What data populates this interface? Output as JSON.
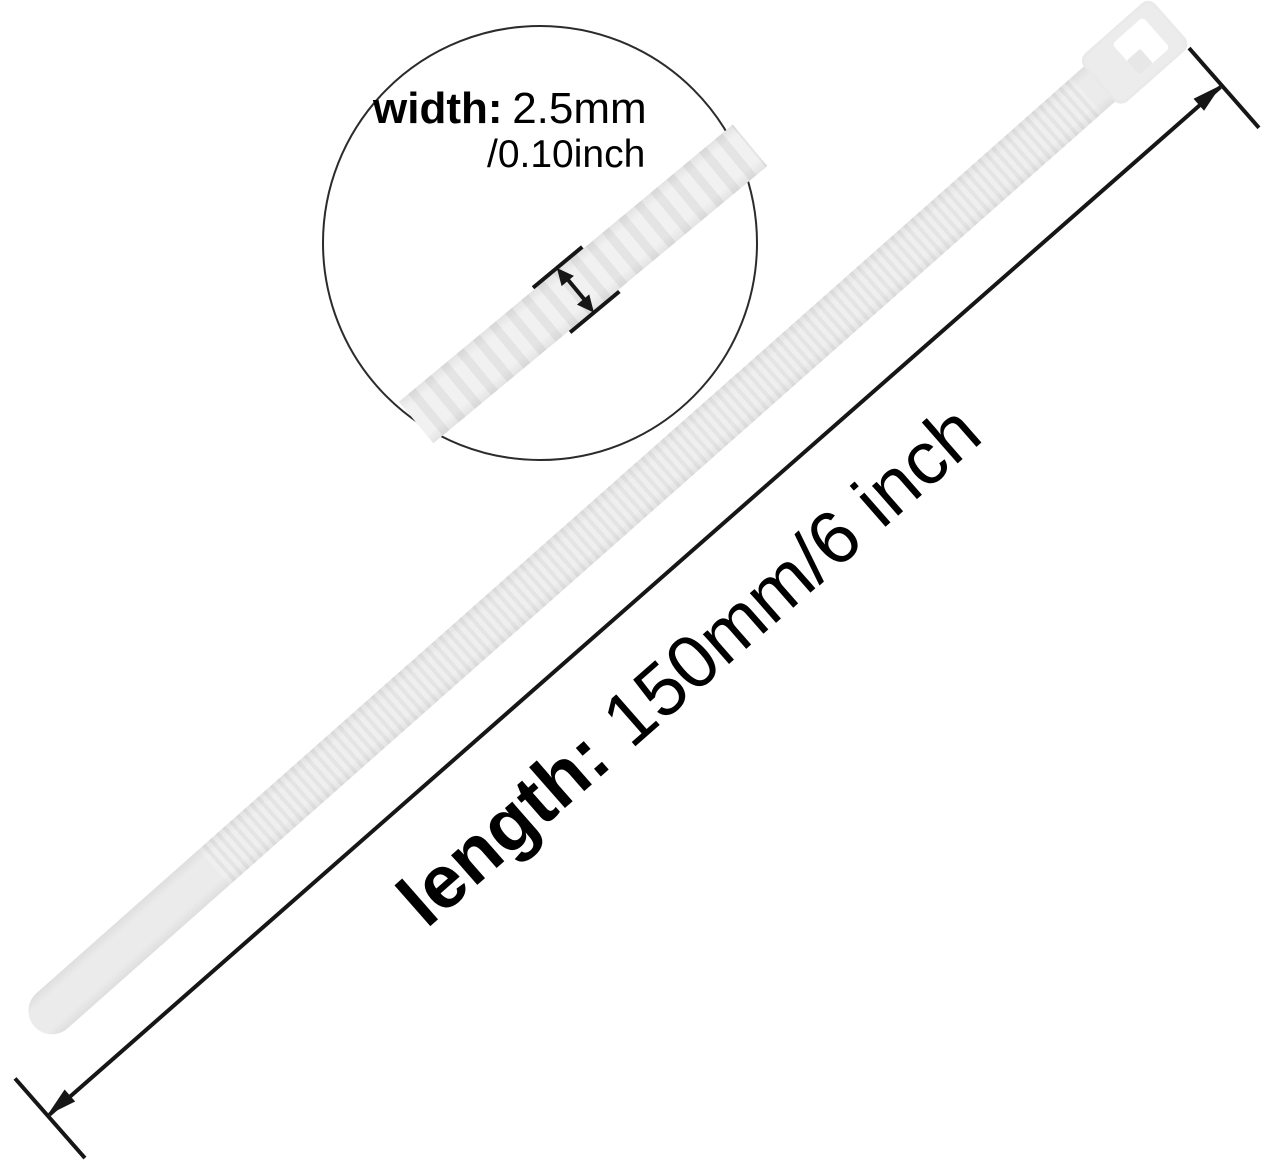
{
  "width_callout": {
    "label": "width:",
    "value": "2.5mm",
    "alt_value": "/0.10inch"
  },
  "length_callout": {
    "label": "length:",
    "value": "150mm/6 inch"
  },
  "colors": {
    "background": "#ffffff",
    "annotation_line": "#161616",
    "text": "#000000",
    "tie_fill": "#ebebeb",
    "tie_ridge_light": "#f1f1f1",
    "tie_ridge_dark": "#e4e4e4",
    "head_slot": "#ffffff",
    "circle_outline": "#2b2b2b"
  }
}
